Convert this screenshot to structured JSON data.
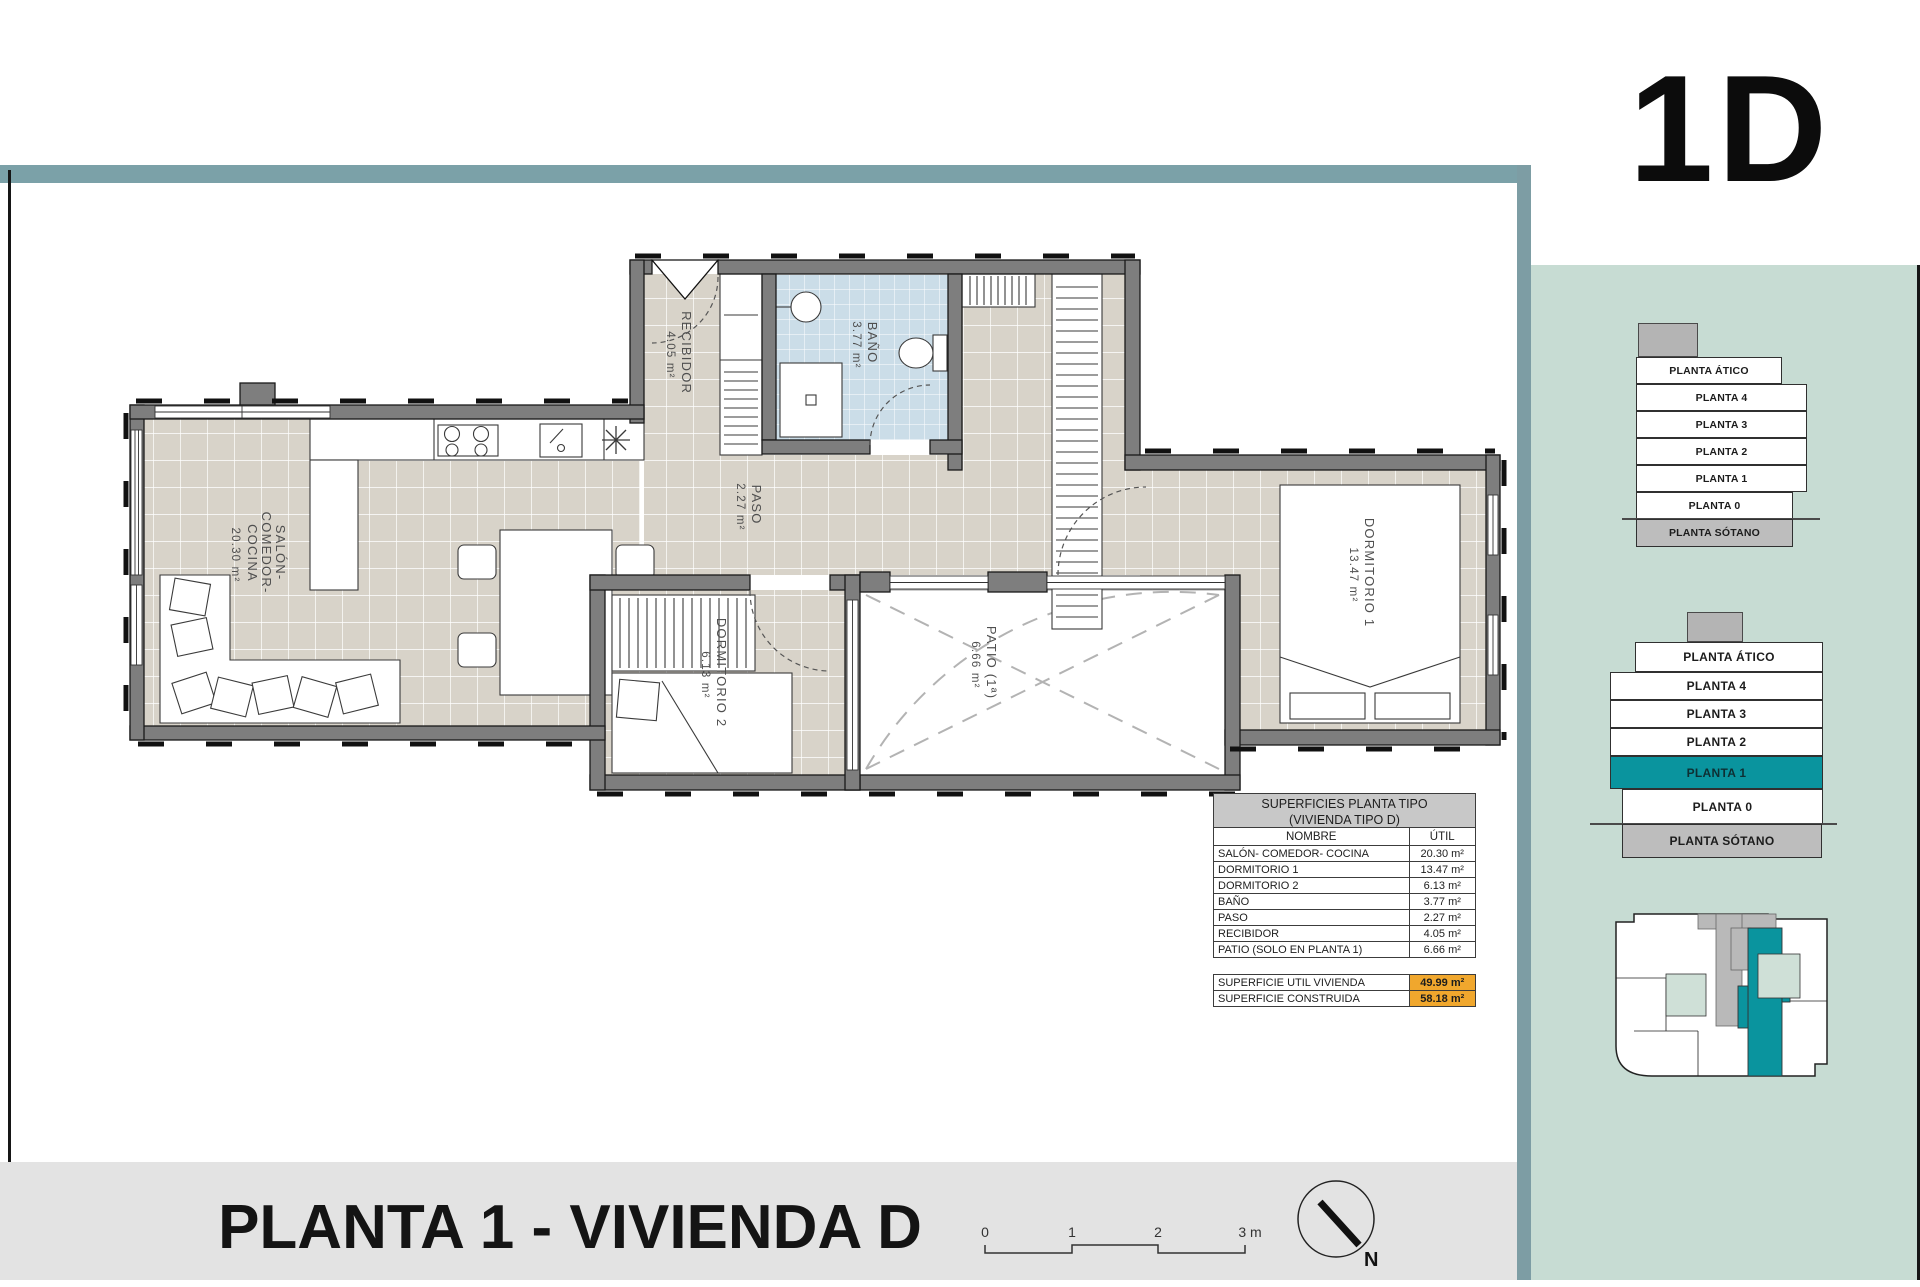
{
  "header": {
    "unit_code": "1D"
  },
  "footer": {
    "title": "PLANTA 1 - VIVIENDA D",
    "scale_labels": [
      "0",
      "1",
      "2",
      "3 m"
    ],
    "north_label": "N"
  },
  "colors": {
    "accent_teal": "#0a949e",
    "sidebar_green": "#c7dcd3",
    "band_blue": "#7ba1a8",
    "highlight_orange": "#f0a72d",
    "bath_blue": "#cbdde8",
    "floor_beige": "#d8d3c9",
    "wall_grey": "#7e7e7e"
  },
  "plan": {
    "rooms": [
      {
        "lines": [
          "SALÓN-",
          "COMEDOR-",
          "COCINA"
        ],
        "area": "20.30 m²"
      },
      {
        "lines": [
          "RECIBIDOR"
        ],
        "area": "4.05 m²"
      },
      {
        "lines": [
          "BAÑO"
        ],
        "area": "3.77 m²"
      },
      {
        "lines": [
          "PASO"
        ],
        "area": "2.27 m²"
      },
      {
        "lines": [
          "DORMITORIO 2"
        ],
        "area": "6.13 m²"
      },
      {
        "lines": [
          "PATIO (1ª)"
        ],
        "area": "6.66 m²"
      },
      {
        "lines": [
          "DORMITORIO 1"
        ],
        "area": "13.47 m²"
      }
    ]
  },
  "table": {
    "title_line1": "SUPERFICIES PLANTA TIPO",
    "title_line2": "(VIVIENDA TIPO D)",
    "col_name": "NOMBRE",
    "col_util": "ÚTIL",
    "rows": [
      {
        "name": "SALÓN- COMEDOR- COCINA",
        "util": "20.30 m²"
      },
      {
        "name": "DORMITORIO 1",
        "util": "13.47 m²"
      },
      {
        "name": "DORMITORIO 2",
        "util": "6.13 m²"
      },
      {
        "name": "BAÑO",
        "util": "3.77 m²"
      },
      {
        "name": "PASO",
        "util": "2.27 m²"
      },
      {
        "name": "RECIBIDOR",
        "util": "4.05 m²"
      },
      {
        "name": "PATIO (SOLO EN PLANTA 1)",
        "util": "6.66 m²"
      }
    ],
    "summary": [
      {
        "name": "SUPERFICIE UTIL VIVIENDA",
        "util": "49.99 m²"
      },
      {
        "name": "SUPERFICIE CONSTRUIDA",
        "util": "58.18 m²"
      }
    ]
  },
  "sidebar": {
    "stack_top": {
      "floors": [
        "PLANTA ÁTICO",
        "PLANTA 4",
        "PLANTA 3",
        "PLANTA 2",
        "PLANTA 1",
        "PLANTA 0",
        "PLANTA SÓTANO"
      ]
    },
    "stack_bottom": {
      "floors": [
        "PLANTA ÁTICO",
        "PLANTA 4",
        "PLANTA 3",
        "PLANTA 2",
        "PLANTA 1",
        "PLANTA 0",
        "PLANTA SÓTANO"
      ],
      "highlighted_floor": "PLANTA 1"
    }
  }
}
